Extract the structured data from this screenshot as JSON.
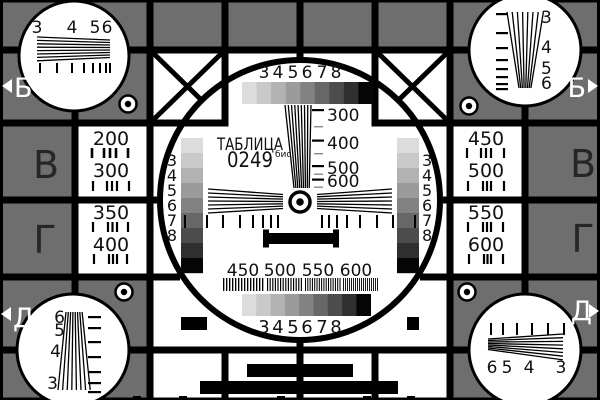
{
  "card_name": "ТАБЛИЦА 0249 бис test card",
  "colors": {
    "background": "#6e6e6e",
    "white": "#ffffff",
    "black": "#000000",
    "dark_letter": "#262626",
    "gray_steps": [
      "#dcdcdc",
      "#c9c9c9",
      "#b2b2b2",
      "#9b9b9b",
      "#828282",
      "#676767",
      "#4c4c4c",
      "#2f2f2f",
      "#050505"
    ]
  },
  "title": {
    "name": "ТАБЛИЦА",
    "number": "0249",
    "suffix": "бис"
  },
  "edges": {
    "left": [
      "Б",
      "В",
      "Г",
      "Д"
    ],
    "right": [
      "Б",
      "В",
      "Г",
      "Д"
    ]
  },
  "corners": {
    "tl": [
      "3",
      "4",
      "5",
      "6"
    ],
    "tr": [
      "3",
      "4",
      "5",
      "6"
    ],
    "bl": [
      "6",
      "5",
      "4",
      "3"
    ],
    "br": [
      "6",
      "5",
      "4",
      "3"
    ]
  },
  "freq_columns": {
    "left": [
      "200",
      "300",
      "350",
      "400"
    ],
    "right": [
      "450",
      "500",
      "550",
      "600"
    ]
  },
  "center": {
    "top_gray": [
      "3",
      "4",
      "5",
      "6",
      "7",
      "8"
    ],
    "bottom_gray": [
      "3",
      "4",
      "5",
      "6",
      "7",
      "8"
    ],
    "left_gray": [
      "3",
      "4",
      "5",
      "6",
      "7",
      "8"
    ],
    "right_gray": [
      "3",
      "4",
      "5",
      "6",
      "7",
      "8"
    ],
    "wedge": [
      "300",
      "400",
      "500",
      "600"
    ],
    "burst": [
      "450",
      "500",
      "550",
      "600"
    ]
  }
}
